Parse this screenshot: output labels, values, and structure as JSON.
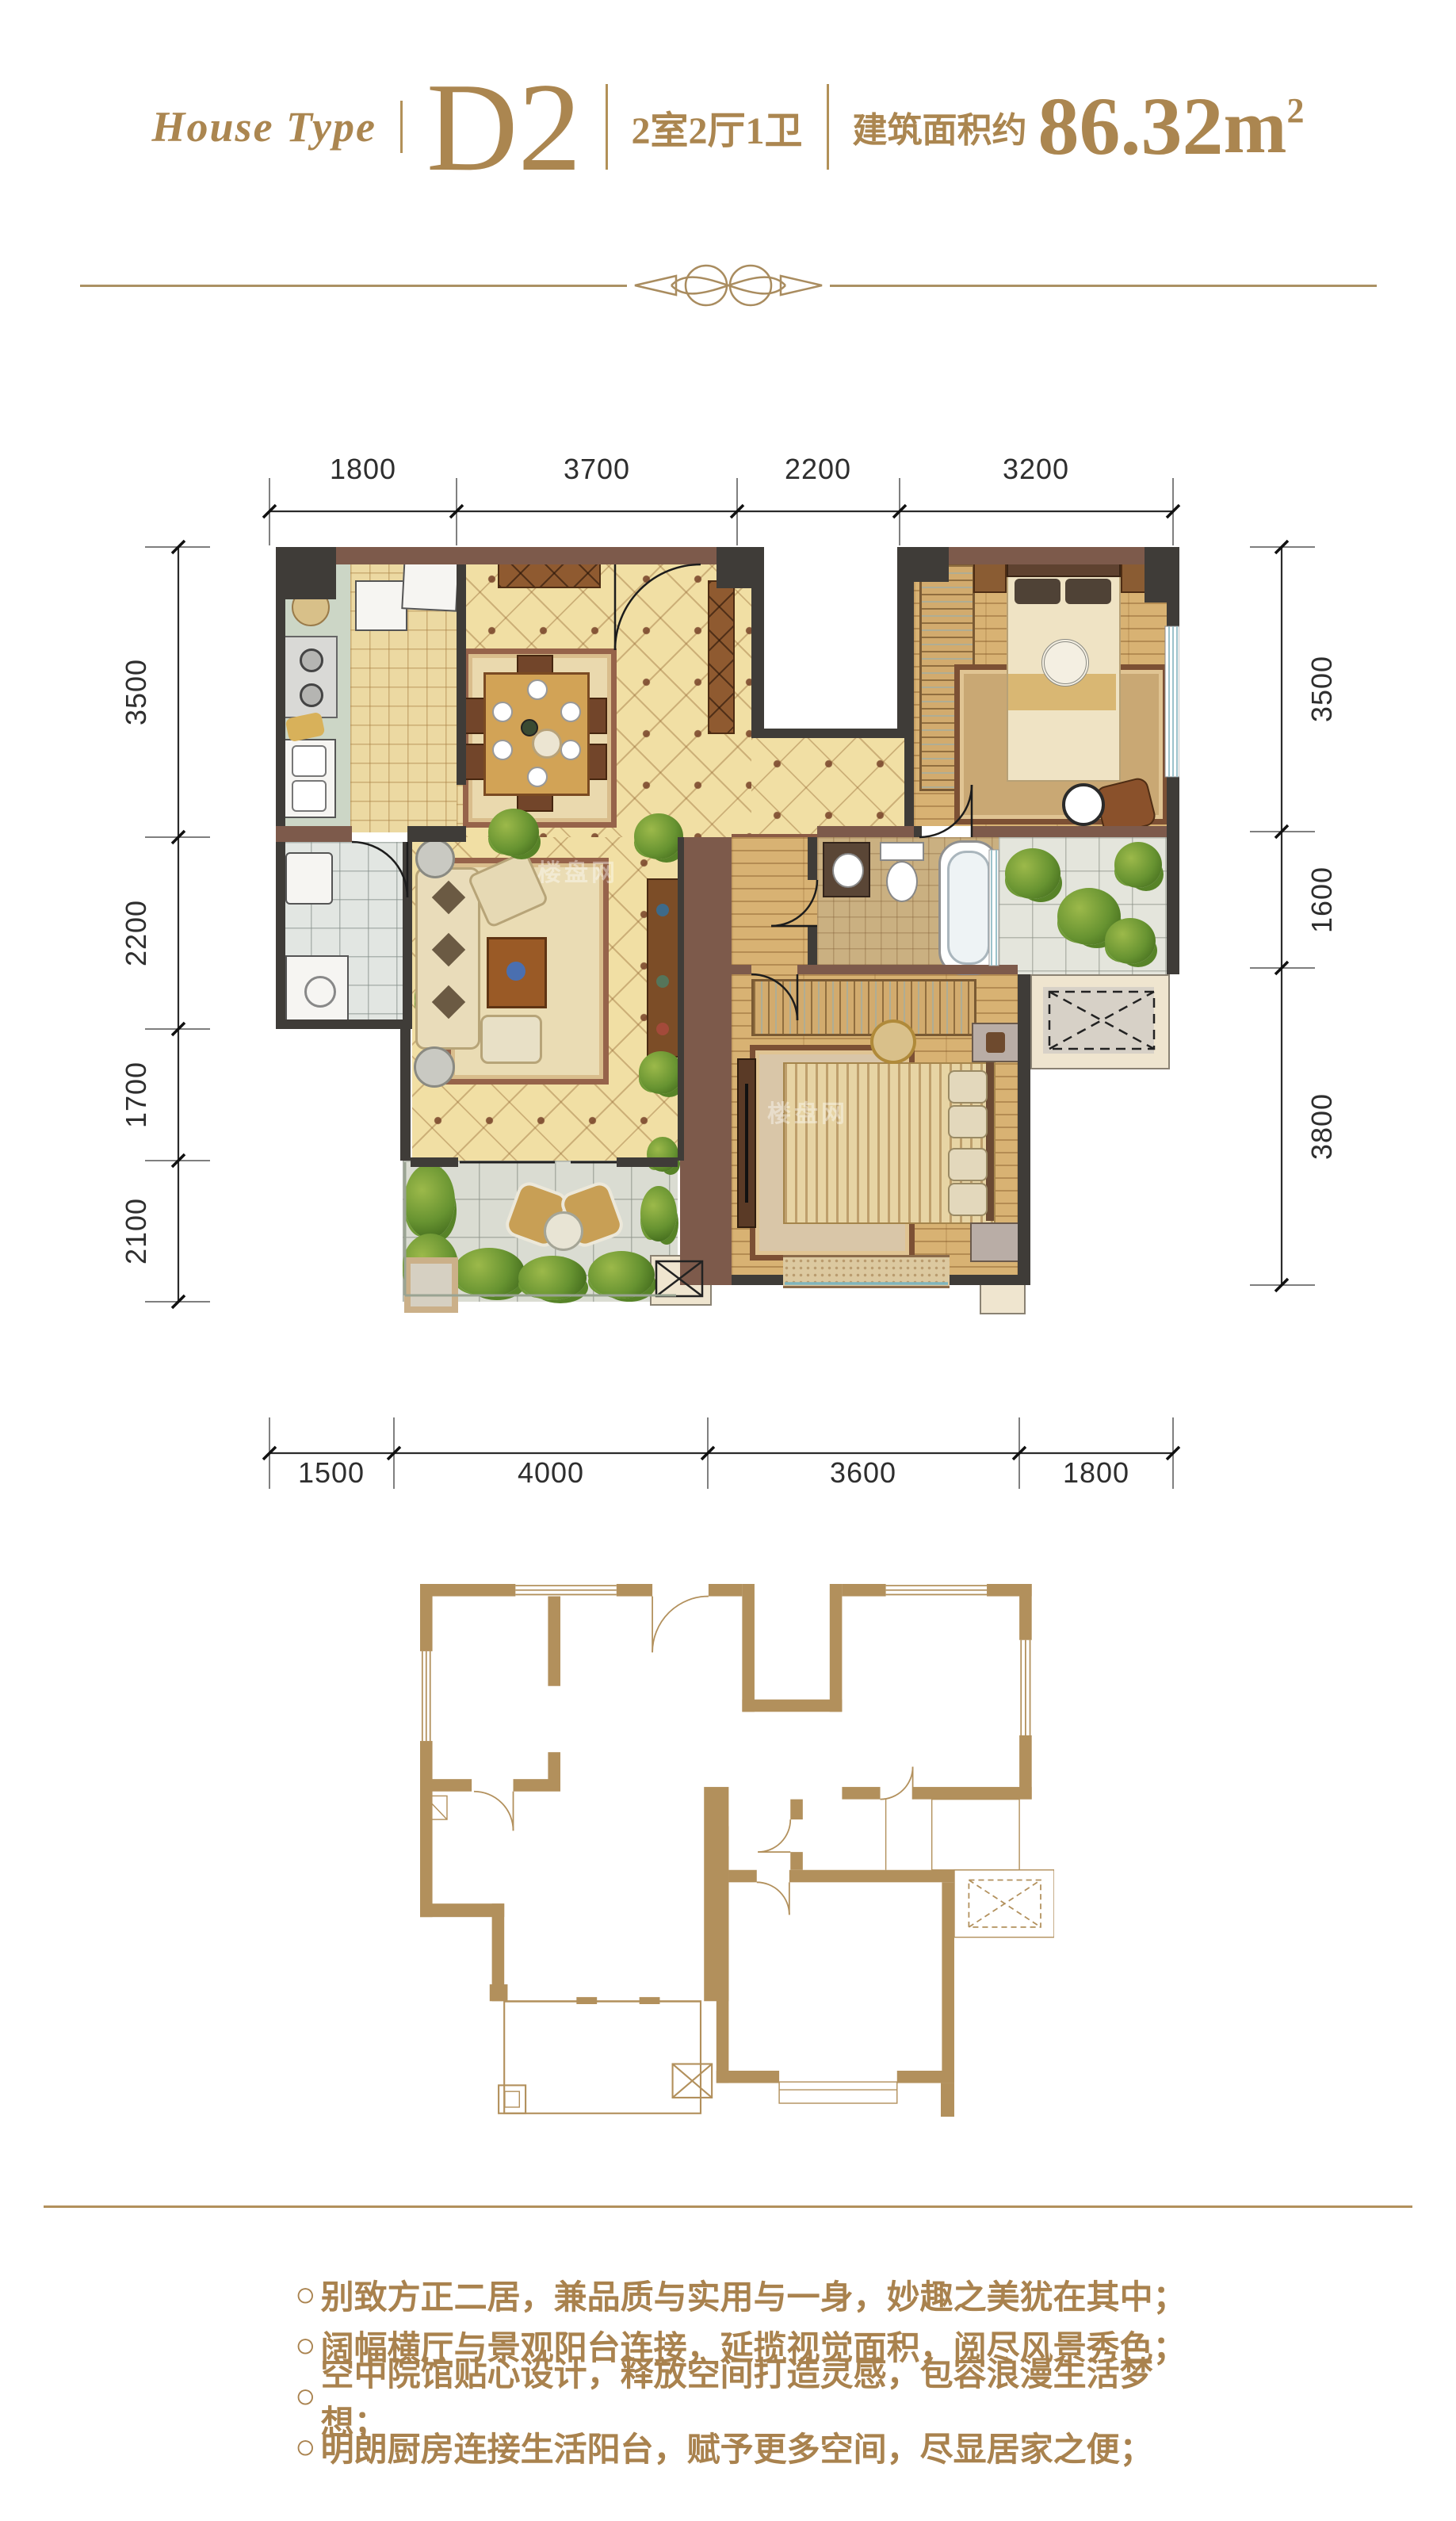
{
  "header": {
    "brand": "House Type",
    "code": "D2",
    "rooms": "2室2厅1卫",
    "area_label": "建筑面积约",
    "area_number": "86.32",
    "area_unit": "m",
    "area_exponent": "2"
  },
  "dims": {
    "top": [
      "1800",
      "3700",
      "2200",
      "3200"
    ],
    "left": [
      "3500",
      "2200",
      "1700",
      "2100"
    ],
    "right": [
      "3500",
      "1600",
      "3800"
    ],
    "bottom": [
      "1500",
      "4000",
      "3600",
      "1800"
    ]
  },
  "bullet": "○",
  "features": [
    "别致方正二居，兼品质与实用与一身，妙趣之美犹在其中；",
    "阔幅横厅与景观阳台连接，延揽视觉面积，阅尽风景秀色；",
    "空中院馆贴心设计，释放空间打造灵感，包容浪漫生活梦想；",
    "明朗厨房连接生活阳台，赋予更多空间，尽显居家之便；"
  ],
  "watermark": "楼盘网",
  "colors": {
    "accent_gold": "#ab8650",
    "dim_text": "#2e2e2e",
    "wall_dark": "#3f3c38",
    "wall_brown": "#7d5a4b",
    "tile_cream": "#f1dfa4",
    "wood": "#d8b273",
    "outline_gold": "#b2905c"
  }
}
